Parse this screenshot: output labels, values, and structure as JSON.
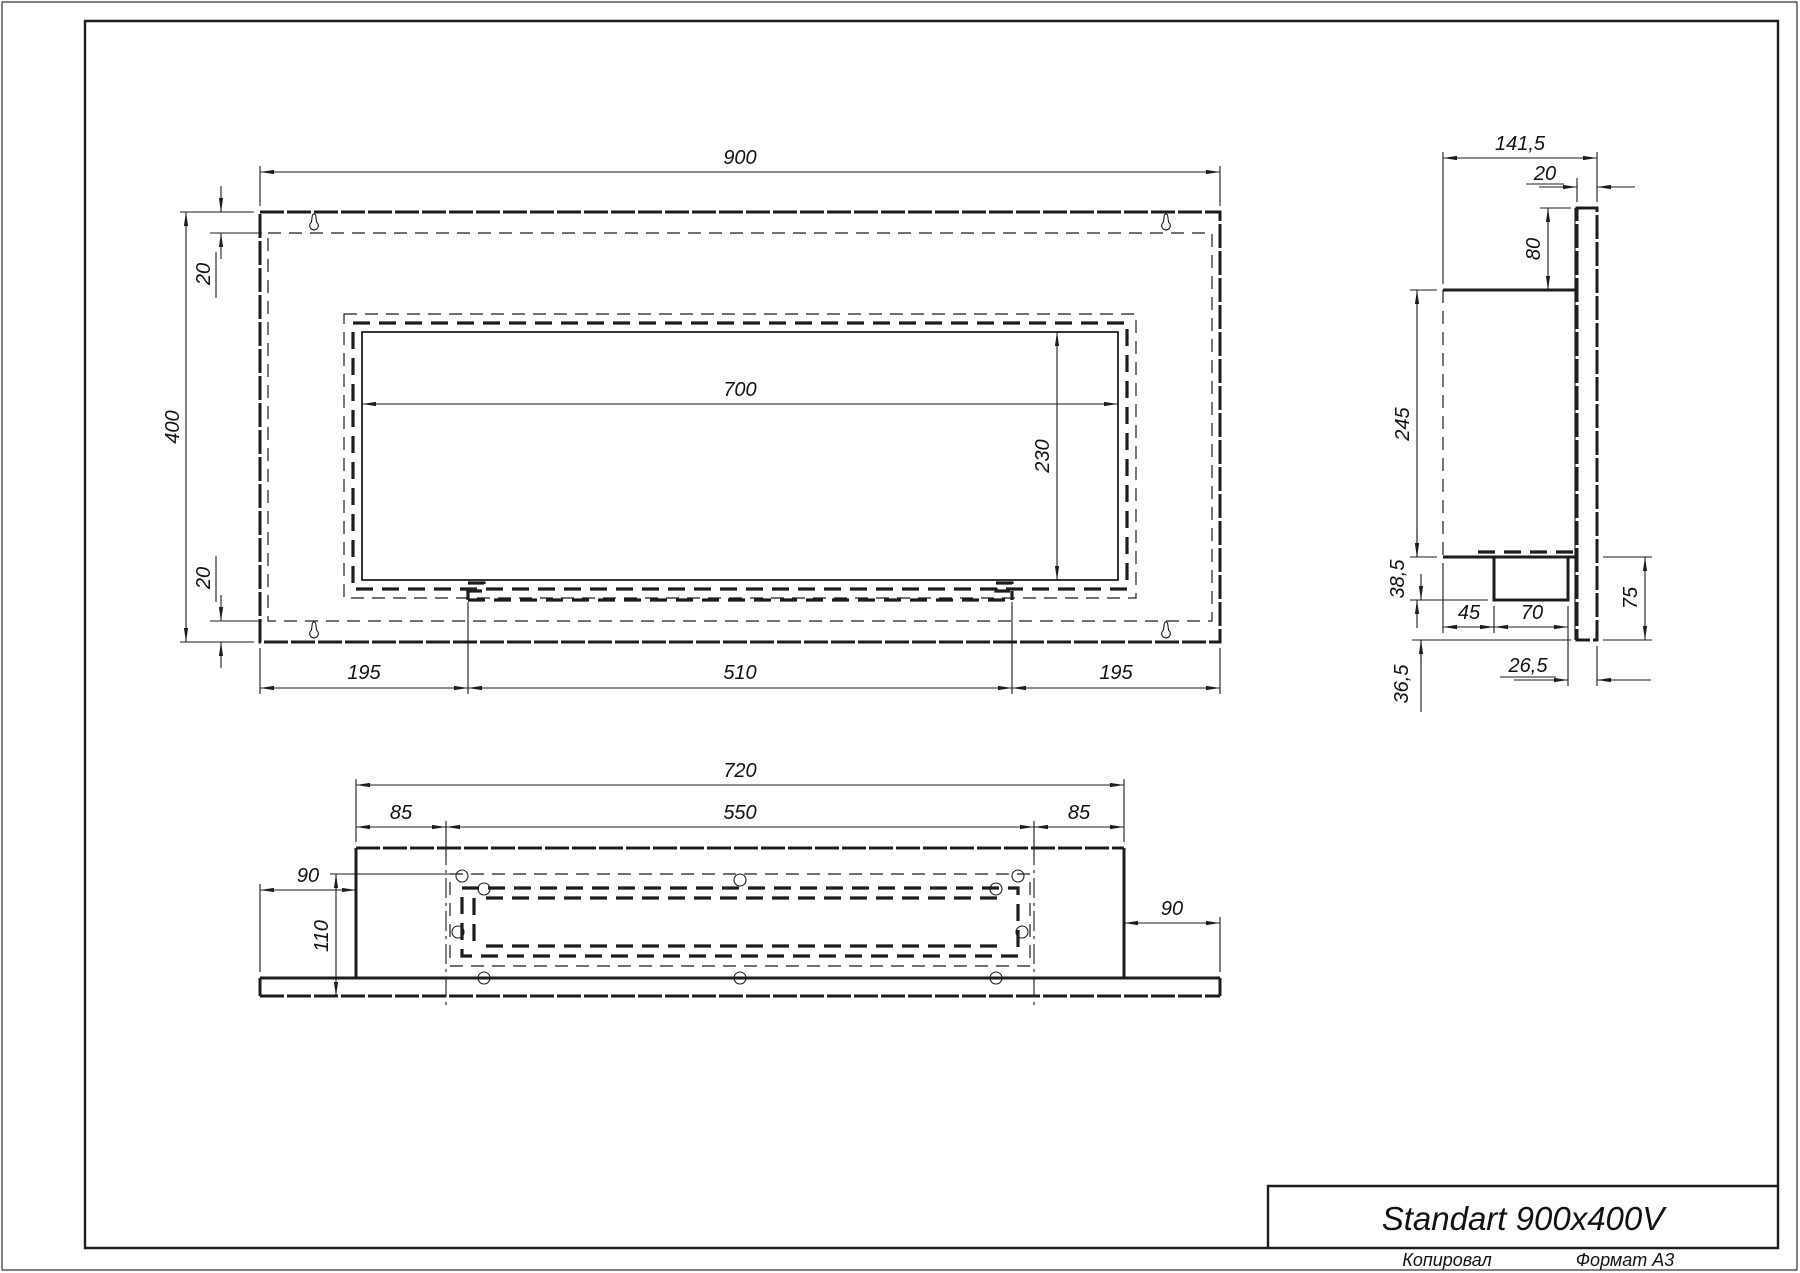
{
  "colors": {
    "ink": "#1d1d1d",
    "paper": "#ffffff"
  },
  "front_view": {
    "dims": {
      "overall_width": "900",
      "overall_height": "400",
      "top_flange": "20",
      "bottom_flange": "20",
      "opening_width": "700",
      "opening_height": "230",
      "left_margin": "195",
      "tank_width": "510",
      "right_margin": "195"
    }
  },
  "side_view": {
    "dims": {
      "overall_depth": "141,5",
      "plate_thickness": "20",
      "top_drop": "80",
      "body_height": "245",
      "tray_drop": "38,5",
      "tray_offset": "45",
      "tray_width": "70",
      "below_body": "75",
      "tray_to_plate": "26,5",
      "plate_overhang": "36,5"
    }
  },
  "top_view": {
    "dims": {
      "body_width": "720",
      "mount_span": "550",
      "left_inset": "85",
      "right_inset": "85",
      "left_overhang": "90",
      "right_overhang": "90",
      "burner_depth": "110"
    }
  },
  "title_block": {
    "product_name": "Standart 900x400V",
    "copied_label": "Копировал",
    "format_label": "Формат А3"
  }
}
